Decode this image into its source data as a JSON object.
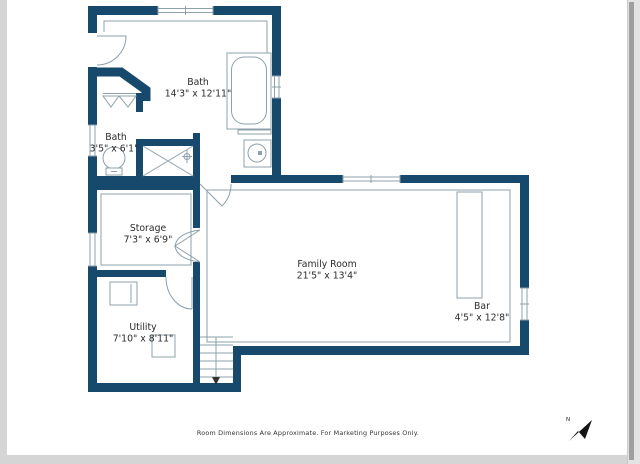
{
  "document": {
    "type": "floor-plan",
    "disclaimer": "Room Dimensions Are Approximate. For Marketing Purposes Only.",
    "compass_label": "N"
  },
  "colors": {
    "wall": "#17496d",
    "fixture_line": "#8da0ab",
    "page": "#ffffff",
    "canvas": "#d5d5d5",
    "text": "#2b2b2b"
  },
  "rooms": [
    {
      "name": "Bath",
      "dims": "14'3\" x 12'11\""
    },
    {
      "name": "Bath",
      "dims": "3'5\" x 6'1\""
    },
    {
      "name": "Storage",
      "dims": "7'3\" x 6'9\""
    },
    {
      "name": "Family Room",
      "dims": "21'5\" x 13'4\""
    },
    {
      "name": "Bar",
      "dims": "4'5\" x 12'8\""
    },
    {
      "name": "Utility",
      "dims": "7'10\" x 8'11\""
    }
  ],
  "fixtures": [
    "bathtub",
    "shower",
    "sink",
    "toilet",
    "bifold-closet-doors",
    "water-heater",
    "appliance",
    "bar-counter",
    "stairs-down"
  ]
}
